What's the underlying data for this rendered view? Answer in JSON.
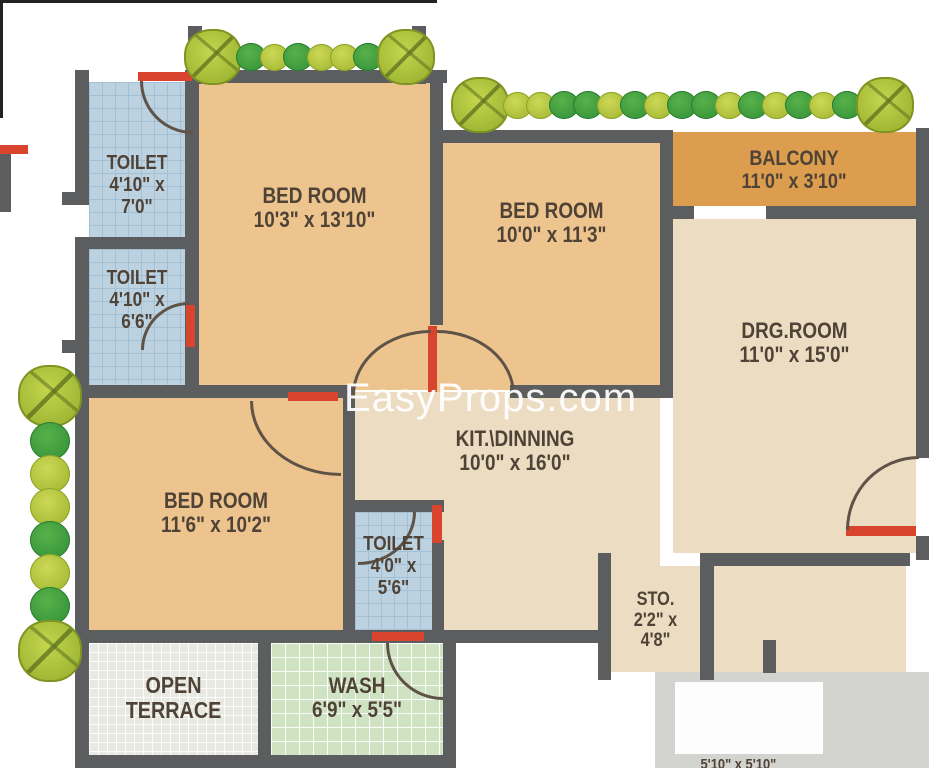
{
  "watermark": "EasyProps.com",
  "rooms": {
    "toilet_top": {
      "name": "TOILET",
      "dim1": "4'10\" x",
      "dim2": "7'0\""
    },
    "toilet_mid": {
      "name": "TOILET",
      "dim1": "4'10\" x",
      "dim2": "6'6\""
    },
    "bed_top": {
      "name": "BED ROOM",
      "dims": "10'3\" x 13'10\""
    },
    "bed_mid": {
      "name": "BED ROOM",
      "dims": "10'0\" x 11'3\""
    },
    "balcony": {
      "name": "BALCONY",
      "dims": "11'0\" x 3'10\""
    },
    "drg": {
      "name": "DRG.ROOM",
      "dims": "11'0\" x 15'0\""
    },
    "kit": {
      "name": "KIT.\\DINNING",
      "dims": "10'0\" x 16'0\""
    },
    "bed_bottom": {
      "name": "BED ROOM",
      "dims": "11'6\" x 10'2\""
    },
    "toilet_bottom": {
      "name": "TOILET",
      "dim1": "4'0\" x",
      "dim2": "5'6\""
    },
    "sto": {
      "name": "STO.",
      "dim1": "2'2\" x",
      "dim2": "4'8\""
    },
    "terrace": {
      "name": "OPEN",
      "name2": "TERRACE"
    },
    "wash": {
      "name": "WASH",
      "dims": "6'9\" x 5'5\""
    },
    "cutoff_text": "5'10\" x 5'10\""
  },
  "colors": {
    "wall": "#5b5d5f",
    "bedroom": "#eec48e",
    "cream": "#ecdcc1",
    "balcony": "#dc9d4e",
    "toilet": "#bdd2e1",
    "wash": "#cfe3c3",
    "terrace": "#e9e9e4",
    "gray": "#d3d3d0",
    "door_red": "#d8442e",
    "label_text": "#4f4337",
    "tree_green": "#3da23f",
    "tree_lime": "#a7bf3b"
  },
  "trees": {
    "row_top_left": [
      "big",
      "green",
      "lime",
      "green",
      "lime",
      "lime",
      "green",
      "big"
    ],
    "row_top_right": [
      "big",
      "lime",
      "lime",
      "green",
      "green",
      "lime",
      "green",
      "lime",
      "green",
      "green",
      "lime",
      "green",
      "lime",
      "green",
      "lime",
      "green",
      "big"
    ],
    "column_left": [
      "big",
      "green",
      "lime",
      "lime",
      "green",
      "lime",
      "green",
      "big"
    ]
  }
}
